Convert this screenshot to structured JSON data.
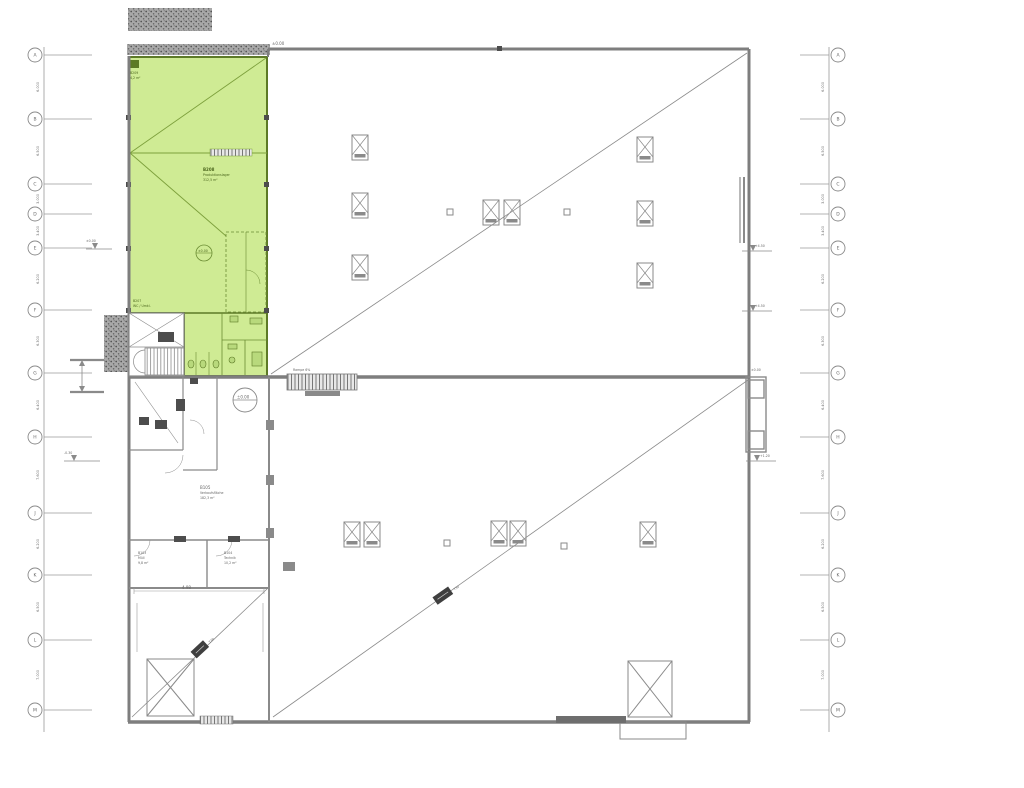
{
  "meta": {
    "drawing_type": "architectural-floor-plan",
    "highlight_color": "#cfeb94",
    "wall_color": "#7e7e7e",
    "thin_line_color": "#9a9a9a",
    "green_line_color": "#7da03c",
    "dark_color": "#4d4d4d"
  },
  "grid": {
    "y": [
      55,
      119,
      184,
      214,
      248,
      310,
      373,
      437,
      513,
      575,
      640,
      710
    ],
    "labels_left": [
      "A",
      "B",
      "C",
      "D",
      "E",
      "F",
      "G",
      "H",
      "J",
      "K",
      "L",
      "M"
    ],
    "labels_right": [
      "A",
      "B",
      "C",
      "D",
      "E",
      "F",
      "G",
      "H",
      "J",
      "K",
      "L",
      "M"
    ],
    "dims": [
      "6.000",
      "6.500",
      "3.000",
      "3.400",
      "6.200",
      "6.300",
      "6.400",
      "7.600",
      "6.200",
      "6.500",
      "7.000"
    ],
    "dim_y": [
      87,
      151,
      199,
      231,
      279,
      341,
      405,
      475,
      544,
      607,
      675
    ]
  },
  "plan": {
    "columns": [
      [
        352,
        135
      ],
      [
        352,
        193
      ],
      [
        352,
        255
      ],
      [
        483,
        200
      ],
      [
        504,
        200
      ],
      [
        637,
        137
      ],
      [
        637,
        201
      ],
      [
        637,
        263
      ],
      [
        344,
        522
      ],
      [
        364,
        522
      ],
      [
        491,
        521
      ],
      [
        510,
        521
      ],
      [
        640,
        522
      ]
    ],
    "small_squares": [
      [
        447,
        209
      ],
      [
        564,
        209
      ],
      [
        444,
        540
      ],
      [
        561,
        543
      ]
    ]
  },
  "annotations": {
    "top_level_note": "±0.00",
    "divider_ramp_note": "Rampe 6%",
    "right_leader_1": "+4.50",
    "right_leader_2": "+4.50",
    "right_leader_3": "+1.20",
    "right_dock_note": "±0.00",
    "left_leader_1": "±0.00",
    "left_leader_2": "-0.30",
    "level_circle_green": "±0.00",
    "level_circle_main": "±0.00",
    "dim_bottom_room": "4.98",
    "diag_tag_lower": "T30",
    "diag_tag_room": "T30",
    "rooms": {
      "green_main": [
        "B208",
        "Produktionslager",
        "312,5 m²"
      ],
      "green_top": [
        "B209",
        "4,2 m²"
      ],
      "green_wc": [
        "B207",
        "WC / Umkl."
      ],
      "b105": [
        "B105",
        "Verkaufsfläche",
        "182,3 m²"
      ],
      "b103": [
        "B103",
        "Müll",
        "9,8 m²"
      ],
      "b104": [
        "B104",
        "Technik",
        "10,2 m²"
      ]
    }
  }
}
